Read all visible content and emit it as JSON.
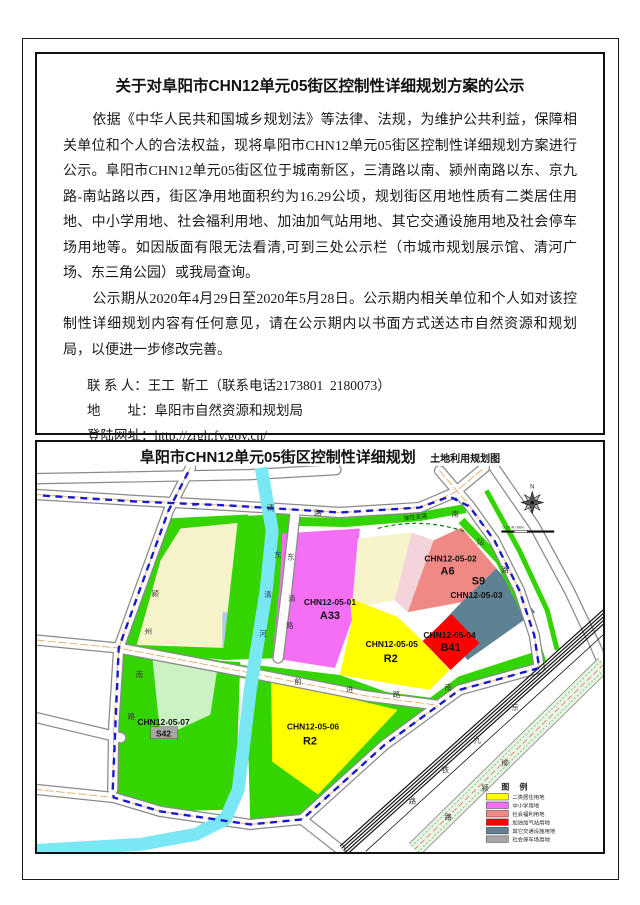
{
  "notice": {
    "title": "关于对阜阳市CHN12单元05街区控制性详细规划方案的公示",
    "paragraph1": "依据《中华人民共和国城乡规划法》等法律、法规，为维护公共利益，保障相关单位和个人的合法权益，现将阜阳市CHN12单元05街区控制性详细规划方案进行公示。阜阳市CHN12单元05街区位于城南新区，三清路以南、颍州南路以东、京九路-南站路以西，街区净用地面积约为16.29公顷，规划街区用地性质有二类居住用地、中小学用地、社会福利用地、加油加气站用地、其它交通设施用地及社会停车场用地等。如因版面有限无法看清,可到三处公示栏（市城市规划展示馆、清河广场、东三角公园）或我局查询。",
    "paragraph2": "公示期从2020年4月29日至2020年5月28日。公示期内相关单位和个人如对该控制性详细规划内容有任何意见，请在公示期内以书面方式送达市自然资源和规划局，以便进一步修改完善。",
    "contact_label": "联 系 人：",
    "contact_value": "王工  靳工（联系电话2173801  2180073）",
    "address_label": "地　　址：",
    "address_value": "阜阳市自然资源和规划局",
    "website_label": "登陆网址：",
    "website_value": "http://zrgh.fy.gov.cn/",
    "date": "2020年4月29日"
  },
  "map": {
    "title": "阜阳市CHN12单元05街区控制性详细规划",
    "subtitle": "土地利用规划图",
    "north": "N",
    "scale_text": "0  20  40        80m",
    "elastic_road_label": "弹性支路",
    "legend_title": "图 例",
    "legend": [
      {
        "label": "二类居住用地",
        "color": "#FFFF00"
      },
      {
        "label": "中小学用地",
        "color": "#F46FF4"
      },
      {
        "label": "社会福利用地",
        "color": "#F08884"
      },
      {
        "label": "加油加气站用地",
        "color": "#FF0000"
      },
      {
        "label": "其它交通设施用地",
        "color": "#5E8193"
      },
      {
        "label": "社会停车场用地",
        "color": "#A6A6A6"
      }
    ],
    "parcels": [
      {
        "code": "CHN12-05-01",
        "use": "A33",
        "color": "#F46FF4"
      },
      {
        "code": "CHN12-05-02",
        "use": "A6",
        "color": "#F08884"
      },
      {
        "code": "CHN12-05-03",
        "use": "S9",
        "color": "#5E8193"
      },
      {
        "code": "CHN12-05-04",
        "use": "B41",
        "color": "#FF0000"
      },
      {
        "code": "CHN12-05-05",
        "use": "R2",
        "color": "#FFFF00"
      },
      {
        "code": "CHN12-05-06",
        "use": "R2",
        "color": "#FFFF00"
      },
      {
        "code": "CHN12-05-07",
        "use": "S42",
        "color": "#A6A6A6"
      }
    ],
    "roads": {
      "sanqing": [
        "三",
        "清",
        "路"
      ],
      "yingzhou": [
        "颍",
        "州",
        "南",
        "路"
      ],
      "dongqinghe": [
        "东",
        "清",
        "河"
      ],
      "dongqinglu": [
        "东",
        "清",
        "路"
      ],
      "qianjin": [
        "前",
        "进",
        "路"
      ],
      "nanzhan": [
        "南",
        "站",
        "路"
      ],
      "nanzhan_sw": [
        "南"
      ],
      "railway": [
        "京",
        "九",
        "铁",
        "路"
      ],
      "liuying": [
        "柳",
        "颍",
        "路"
      ]
    }
  }
}
